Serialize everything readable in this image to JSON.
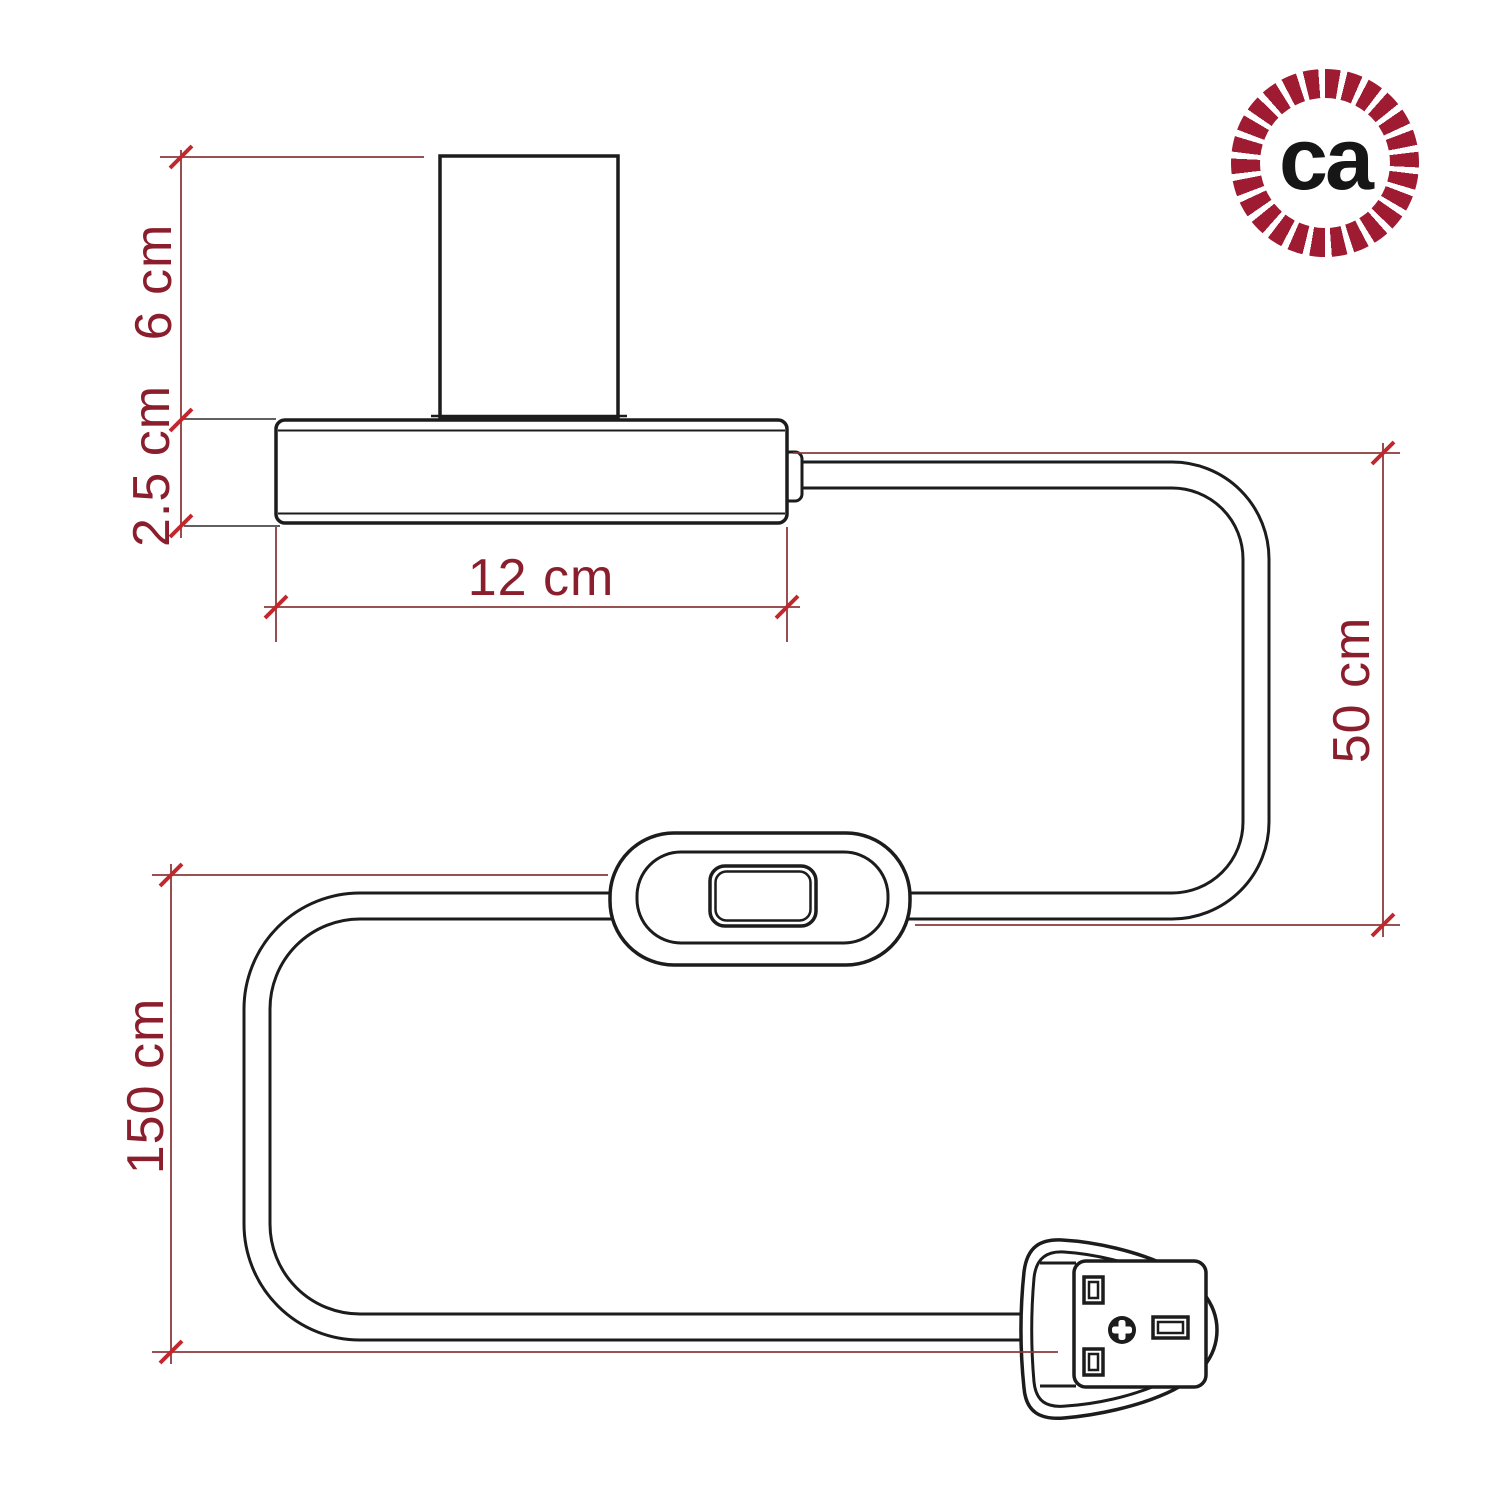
{
  "diagram": {
    "type": "product-dimension-drawing",
    "subject": "table lamp with in-line switch and UK plug",
    "annotations": {
      "lamp_holder_height": "6 cm",
      "base_height": "2.5 cm",
      "base_width": "12 cm",
      "upper_cable_length": "50 cm",
      "lower_cable_length": "150 cm"
    },
    "parts": [
      "cylindrical lamp holder",
      "flat rectangular base",
      "power cable",
      "in-line rocker switch",
      "UK 3-pin plug (pin face view)"
    ]
  },
  "logo": {
    "text": "ca",
    "ring_color": "#9e1b32",
    "text_color": "#161616"
  },
  "colors": {
    "line_art": "#1c1c1c",
    "dimension_line": "#8a3a3a",
    "dimension_extension_dark": "#4a4a4a",
    "tick": "#c1272d",
    "dimension_text": "#8b1e2d",
    "background": "#ffffff"
  }
}
